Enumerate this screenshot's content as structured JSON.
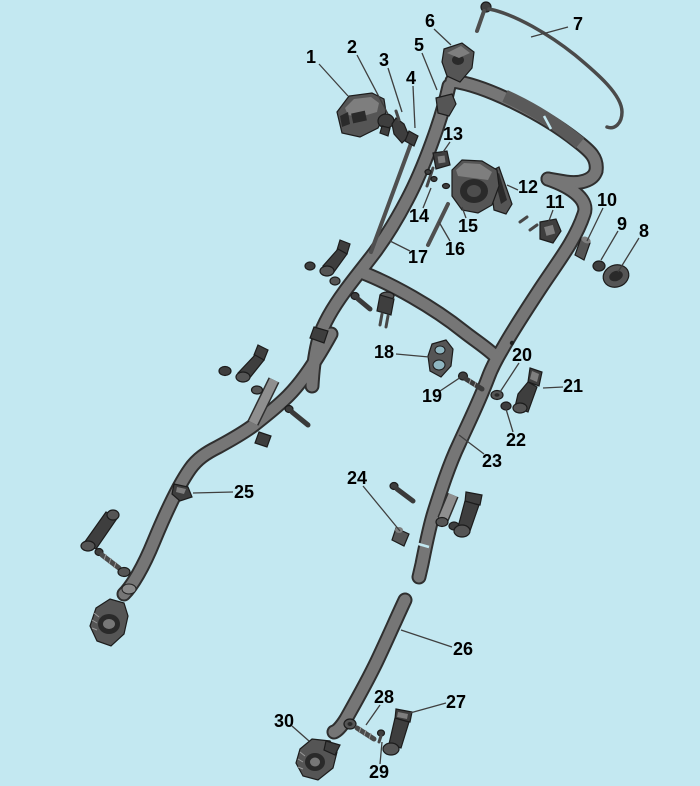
{
  "diagram": {
    "type": "exploded-parts-diagram",
    "background_color": "#c3e8f1",
    "tube_color": "#767676",
    "outline_color": "#2f2f2f",
    "label_color": "#000000",
    "leader_color": "#3f3f3f",
    "callouts": [
      {
        "num": "1",
        "x": 311,
        "y": 57,
        "x1": 319,
        "y1": 64,
        "x2": 348,
        "y2": 96
      },
      {
        "num": "2",
        "x": 352,
        "y": 47,
        "x1": 357,
        "y1": 55,
        "x2": 388,
        "y2": 114
      },
      {
        "num": "3",
        "x": 384,
        "y": 60,
        "x1": 388,
        "y1": 68,
        "x2": 402,
        "y2": 112
      },
      {
        "num": "4",
        "x": 411,
        "y": 78,
        "x1": 413,
        "y1": 86,
        "x2": 415,
        "y2": 128
      },
      {
        "num": "5",
        "x": 419,
        "y": 45,
        "x1": 422,
        "y1": 53,
        "x2": 437,
        "y2": 90
      },
      {
        "num": "6",
        "x": 430,
        "y": 21,
        "x1": 434,
        "y1": 29,
        "x2": 451,
        "y2": 45
      },
      {
        "num": "7",
        "x": 578,
        "y": 24,
        "x1": 568,
        "y1": 27,
        "x2": 531,
        "y2": 37
      },
      {
        "num": "8",
        "x": 644,
        "y": 231,
        "x1": 639,
        "y1": 238,
        "x2": 618,
        "y2": 272
      },
      {
        "num": "9",
        "x": 622,
        "y": 224,
        "x1": 618,
        "y1": 231,
        "x2": 601,
        "y2": 260
      },
      {
        "num": "10",
        "x": 607,
        "y": 200,
        "x1": 603,
        "y1": 208,
        "x2": 587,
        "y2": 241
      },
      {
        "num": "11",
        "x": 555,
        "y": 202,
        "x1": 553,
        "y1": 210,
        "x2": 547,
        "y2": 226
      },
      {
        "num": "12",
        "x": 528,
        "y": 187,
        "x1": 518,
        "y1": 190,
        "x2": 507,
        "y2": 185
      },
      {
        "num": "13",
        "x": 453,
        "y": 134,
        "x1": 450,
        "y1": 142,
        "x2": 441,
        "y2": 155
      },
      {
        "num": "14",
        "x": 419,
        "y": 216,
        "x1": 423,
        "y1": 208,
        "x2": 431,
        "y2": 188
      },
      {
        "num": "15",
        "x": 468,
        "y": 226,
        "x1": 466,
        "y1": 218,
        "x2": 462,
        "y2": 207
      },
      {
        "num": "16",
        "x": 455,
        "y": 249,
        "x1": 450,
        "y1": 241,
        "x2": 439,
        "y2": 222
      },
      {
        "num": "17",
        "x": 418,
        "y": 257,
        "x1": 410,
        "y1": 251,
        "x2": 390,
        "y2": 241
      },
      {
        "num": "18",
        "x": 384,
        "y": 352,
        "x1": 396,
        "y1": 354,
        "x2": 429,
        "y2": 357
      },
      {
        "num": "19",
        "x": 432,
        "y": 396,
        "x1": 440,
        "y1": 391,
        "x2": 461,
        "y2": 377
      },
      {
        "num": "20",
        "x": 522,
        "y": 355,
        "x1": 519,
        "y1": 363,
        "x2": 500,
        "y2": 392
      },
      {
        "num": "21",
        "x": 573,
        "y": 386,
        "x1": 563,
        "y1": 387,
        "x2": 543,
        "y2": 388
      },
      {
        "num": "22",
        "x": 516,
        "y": 440,
        "x1": 513,
        "y1": 432,
        "x2": 506,
        "y2": 409
      },
      {
        "num": "23",
        "x": 492,
        "y": 461,
        "x1": 484,
        "y1": 454,
        "x2": 459,
        "y2": 435
      },
      {
        "num": "24",
        "x": 357,
        "y": 478,
        "x1": 363,
        "y1": 486,
        "x2": 400,
        "y2": 531
      },
      {
        "num": "25",
        "x": 244,
        "y": 492,
        "x1": 233,
        "y1": 492,
        "x2": 193,
        "y2": 493
      },
      {
        "num": "26",
        "x": 463,
        "y": 649,
        "x1": 452,
        "y1": 647,
        "x2": 401,
        "y2": 630
      },
      {
        "num": "27",
        "x": 456,
        "y": 702,
        "x1": 446,
        "y1": 703,
        "x2": 410,
        "y2": 713
      },
      {
        "num": "28",
        "x": 384,
        "y": 697,
        "x1": 380,
        "y1": 705,
        "x2": 366,
        "y2": 725
      },
      {
        "num": "29",
        "x": 379,
        "y": 772,
        "x1": 380,
        "y1": 764,
        "x2": 382,
        "y2": 742
      },
      {
        "num": "30",
        "x": 284,
        "y": 721,
        "x1": 292,
        "y1": 726,
        "x2": 309,
        "y2": 741
      }
    ]
  }
}
